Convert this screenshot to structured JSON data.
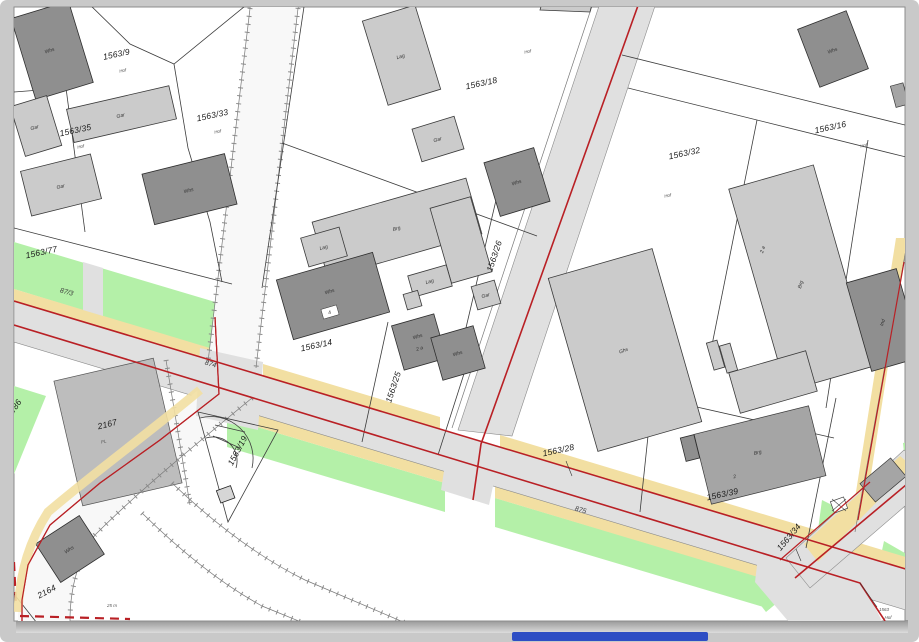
{
  "colors": {
    "frame": "#c9c9c9",
    "paper": "#ffffff",
    "road_red": "#b92025",
    "strip_yellow": "#f2dfa2",
    "area_green": "#b4f0a8",
    "road_gray": "#e0e0e0",
    "building_light": "#cbcbcb",
    "building_dark": "#8f8f8f",
    "building_mid": "#a5a5a5",
    "pavement": "#bdbdbd",
    "parcel_line": "#3c3c3c",
    "taskbar_blue": "#2e4ec4"
  },
  "map": {
    "parcels": [
      {
        "label": "1563/9",
        "sub": "Hof"
      },
      {
        "label": "1563/33",
        "sub": "Hof"
      },
      {
        "label": "1563/35",
        "sub": "Hof"
      },
      {
        "label": "1563/18",
        "sub": "Hof"
      },
      {
        "label": "1563/32",
        "sub": "Hof"
      },
      {
        "label": "1563/16",
        "sub": "Hof"
      },
      {
        "label": "1563/77"
      },
      {
        "label": "1563/14"
      },
      {
        "label": "1563/26"
      },
      {
        "label": "1563/25"
      },
      {
        "label": "1563/28"
      },
      {
        "label": "1563/19"
      },
      {
        "label": "2/86"
      },
      {
        "label": "2167",
        "sub": "PL"
      },
      {
        "label": "2164"
      },
      {
        "label": "1563/39"
      },
      {
        "label": "1563/34"
      },
      {
        "label": "1563",
        "sub": "Hof"
      }
    ],
    "road_labels": [
      "87/3",
      "874",
      "875"
    ],
    "buildings": [
      {
        "label": "Whs"
      },
      {
        "label": "Gar"
      },
      {
        "label": "Gar"
      },
      {
        "label": "Gar"
      },
      {
        "label": "Whs"
      },
      {
        "label": "Lag"
      },
      {
        "label": "Gar"
      },
      {
        "label": "Whs"
      },
      {
        "label": "Brg"
      },
      {
        "label": "Lag"
      },
      {
        "label": "Whs",
        "num": "4"
      },
      {
        "label": "Lag"
      },
      {
        "label": "Gar"
      },
      {
        "label": "Whs",
        "num": "2 a"
      },
      {
        "label": "Whs"
      },
      {
        "label": "Ghs"
      },
      {
        "label": "Brg",
        "num": "2 a"
      },
      {
        "label": "Whs"
      },
      {
        "label": "Whs"
      },
      {
        "label": "Brg",
        "num": "2"
      },
      {
        "label": "Ind"
      }
    ],
    "scale_label": "25 m"
  }
}
